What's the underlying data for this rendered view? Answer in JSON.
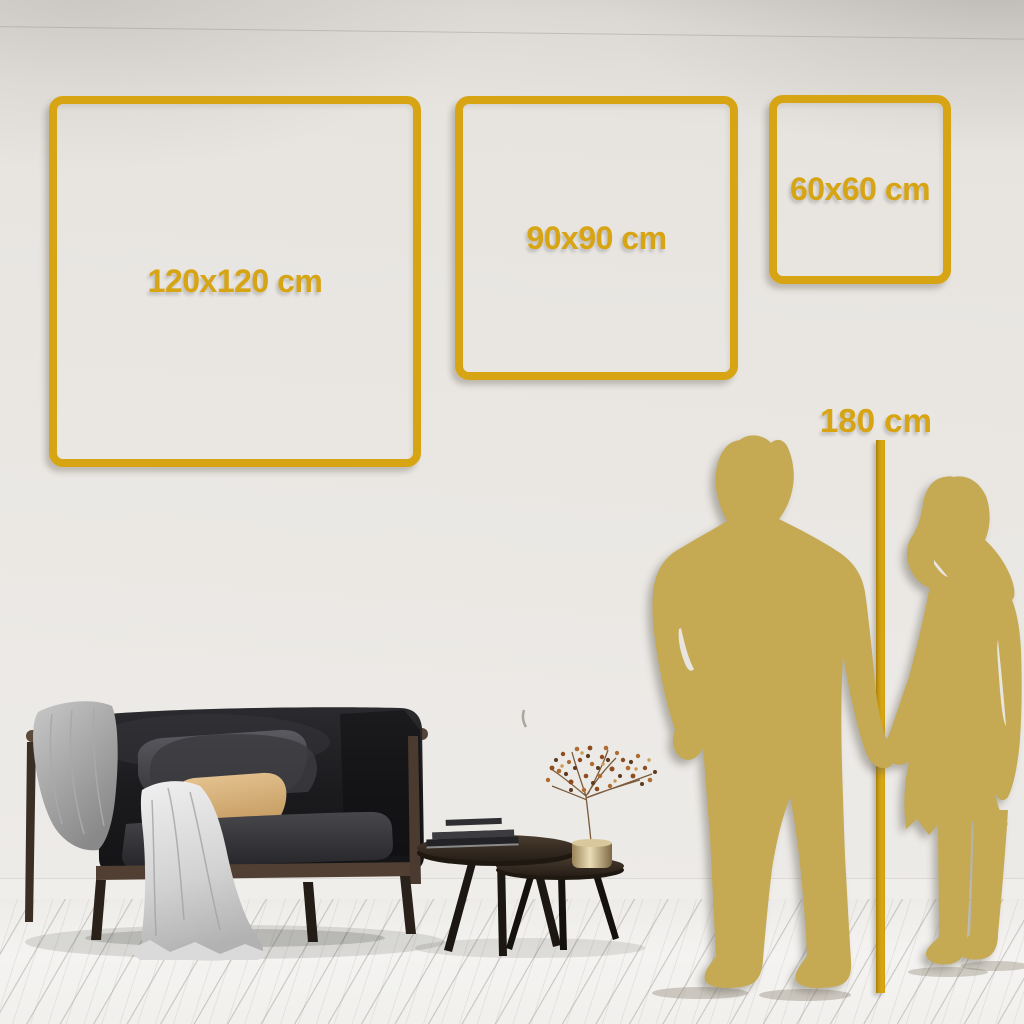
{
  "page": {
    "description": "Wall art size guide mockup: three square frame sizes shown on a living room wall with a couple silhouette and 180 cm height reference"
  },
  "size_frames": [
    {
      "label": "120x120 cm"
    },
    {
      "label": "90x90 cm"
    },
    {
      "label": "60x60 cm"
    }
  ],
  "height_reference": {
    "label": "180 cm"
  },
  "colors": {
    "accent_gold": "#D7A413",
    "silhouette_gold": "#C5A953",
    "wall": "#EAE7E3",
    "floor": "#F2F1EF"
  },
  "scene_objects": [
    "dark-sofa",
    "gray-throw-blanket",
    "white-draped-blanket",
    "gray-pillow",
    "tan-pillow",
    "nesting-coffee-tables",
    "book-stack",
    "brass-vase-dried-plant",
    "man-silhouette",
    "woman-silhouette",
    "height-ruler-line"
  ]
}
